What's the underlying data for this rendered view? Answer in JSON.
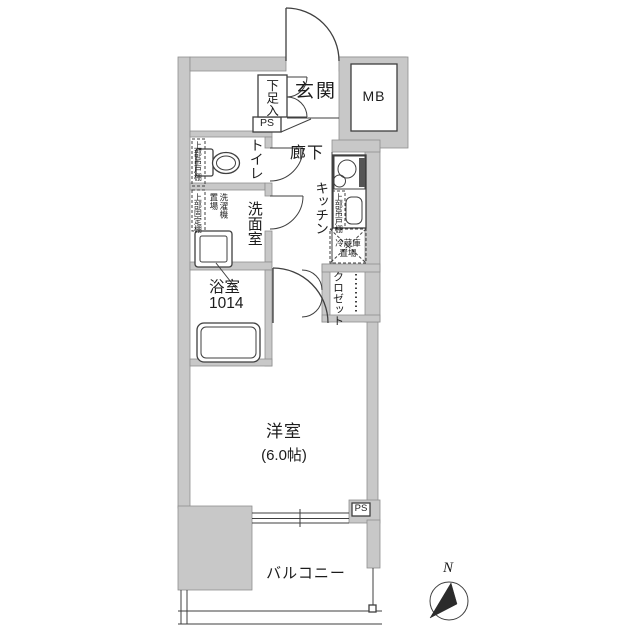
{
  "floorplan": {
    "rooms": {
      "entrance": {
        "label": "玄関"
      },
      "shoe_cabinet": {
        "label": "下足入"
      },
      "meter_box": {
        "label": "MB"
      },
      "pipe_shaft_top": {
        "label": "PS"
      },
      "toilet": {
        "label": "トイレ"
      },
      "toilet_upper_cabinet": {
        "label": "上部吊戸棚"
      },
      "hallway": {
        "label": "廊下"
      },
      "kitchen": {
        "label": "キッチン"
      },
      "kitchen_upper_cabinet": {
        "label": "上部吊戸棚"
      },
      "fridge_space": {
        "line1": "冷蔵庫",
        "line2": "置場"
      },
      "washroom": {
        "label": "洗面室"
      },
      "washroom_upper_shelf": {
        "label": "上部固定棚"
      },
      "washer_space": {
        "line1": "洗濯機",
        "line2": "置場"
      },
      "bathroom": {
        "label": "浴室",
        "size": "1014"
      },
      "closet": {
        "label": "クロゼット"
      },
      "western_room": {
        "label": "洋室",
        "size": "(6.0帖)"
      },
      "pipe_shaft_bottom": {
        "label": "PS"
      },
      "balcony": {
        "label": "バルコニー"
      }
    },
    "compass": {
      "north_label": "N"
    },
    "colors": {
      "wall_fill": "#c8c8c8",
      "line": "#3f3f3f",
      "floor": "#ffffff"
    }
  }
}
